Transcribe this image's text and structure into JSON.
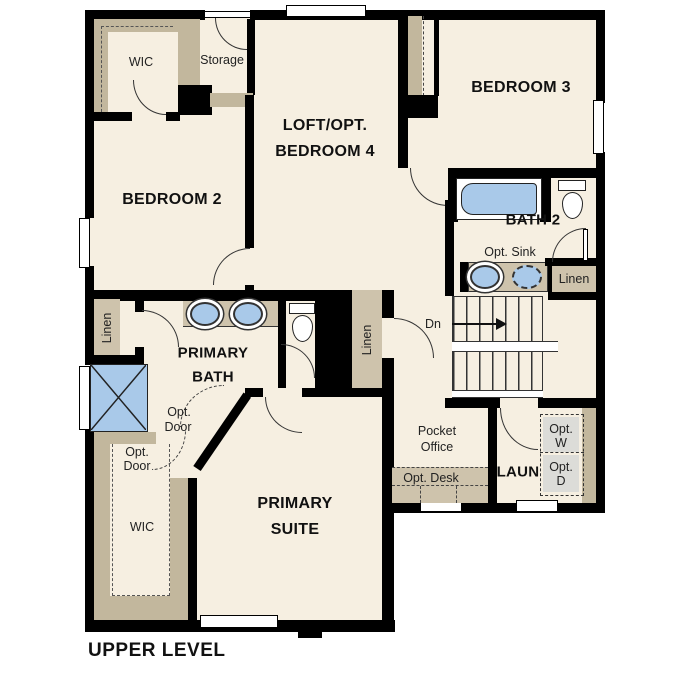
{
  "title": "UPPER LEVEL",
  "colors": {
    "floor": "#f6efe1",
    "wall": "#000000",
    "closet": "#cec3ac",
    "closet2": "#c2b79d",
    "blue": "#a9c9e9",
    "gray": "#dcdcd8"
  },
  "labels": {
    "wic": "WIC",
    "storage": "Storage",
    "bedroom2": "BEDROOM 2",
    "loft": [
      "LOFT/OPT.",
      "BEDROOM 4"
    ],
    "bedroom3": "BEDROOM 3",
    "bath2": "BATH 2",
    "opt_sink": "Opt. Sink",
    "linen": "Linen",
    "dn": "Dn",
    "primary_bath": [
      "PRIMARY",
      "BATH"
    ],
    "opt_door": [
      "Opt.",
      "Door"
    ],
    "primary_suite": [
      "PRIMARY",
      "SUITE"
    ],
    "pocket_office": [
      "Pocket",
      "Office"
    ],
    "opt_desk": "Opt. Desk",
    "laundry": "LAUN",
    "opt_washer": [
      "Opt.",
      "W"
    ],
    "opt_dryer": [
      "Opt.",
      "D"
    ]
  }
}
